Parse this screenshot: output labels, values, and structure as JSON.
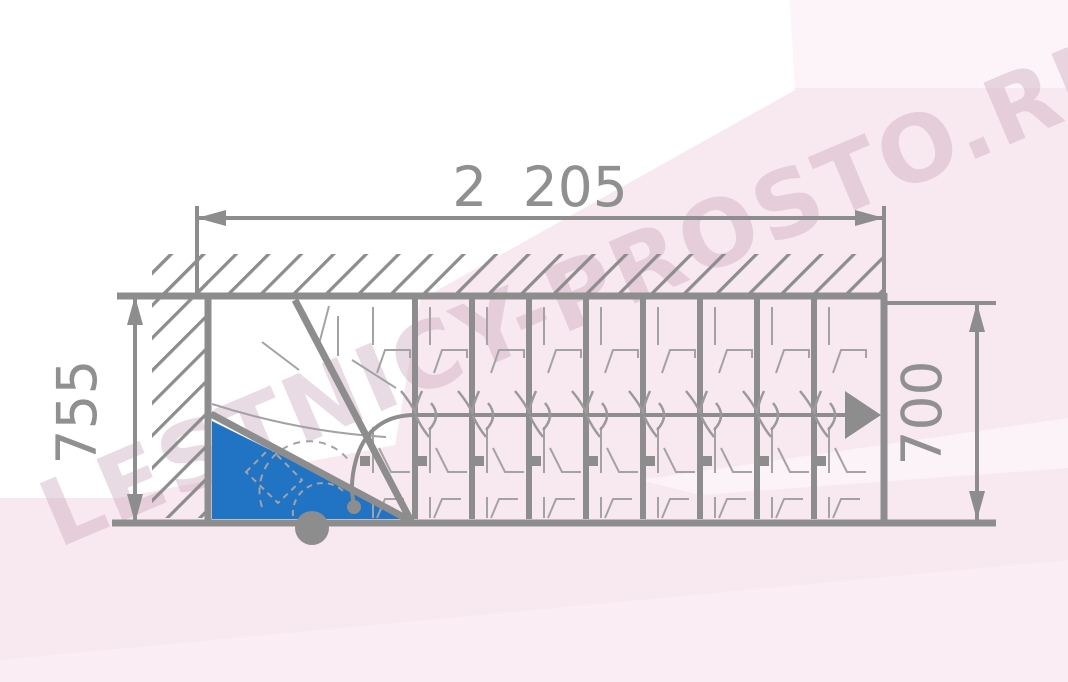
{
  "diagram": {
    "title": "staircase-plan-top-view",
    "dimensions": {
      "width_top": "2 205",
      "height_left": "755",
      "height_right": "700"
    },
    "watermark": "LESTNICY-PROSTO.RU",
    "colors": {
      "line_gray": "#8d8d8d",
      "thin_gray": "#a3a3a3",
      "step_highlight_blue": "#2173c4",
      "background_pink": "#f8e9f1",
      "background_white": "#ffffff",
      "watermark_tint": "#dccfd8"
    },
    "stairs": {
      "straight_step_lines": 8,
      "winder_division_lines": 2,
      "direction": "right"
    }
  }
}
